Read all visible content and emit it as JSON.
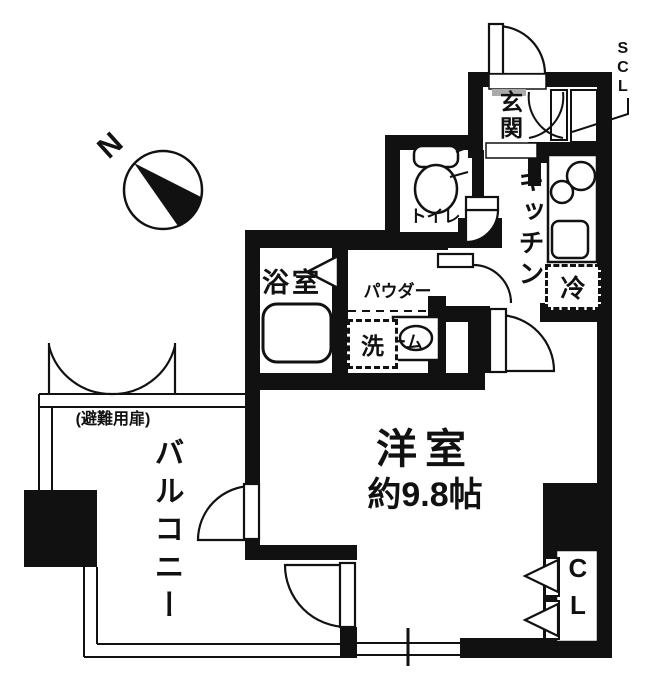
{
  "compass": {
    "north_label": "N"
  },
  "labels": {
    "entrance": "玄関",
    "shoe_closet": "SCL",
    "toilet": "トイレ",
    "kitchen": "キッチン",
    "fridge": "冷",
    "bathroom": "浴室",
    "powder_room_line1": "パウダー",
    "powder_room_line2": "ルーム",
    "washer": "洗",
    "main_room_name": "洋室",
    "main_room_size": "約9.8帖",
    "balcony": "バルコニー",
    "evacuation_door": "(避難用扉)",
    "closet": "CL"
  },
  "colors": {
    "wall": "#111111",
    "background": "#ffffff"
  }
}
